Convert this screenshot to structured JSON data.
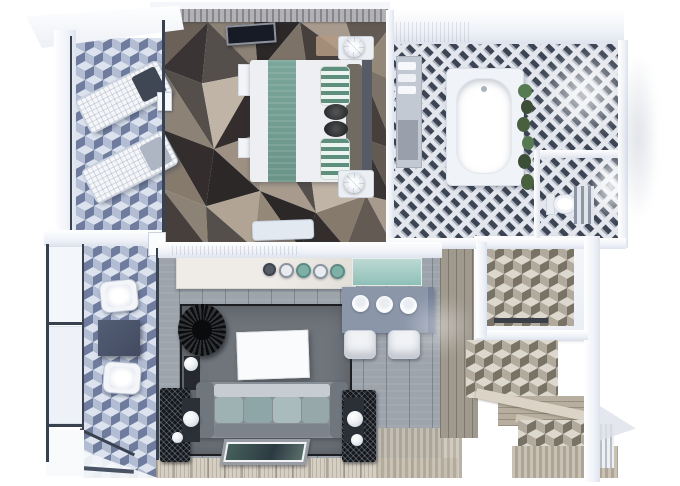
{
  "scene": {
    "type": "3d-floorplan-top-view-render",
    "rooms": [
      {
        "id": "balcony-upper",
        "label": "upper balcony",
        "items": [
          "lounge-chair",
          "lounge-chair",
          "side-table",
          "glass-railing",
          "canopy-roof",
          "cube-tile-floor"
        ]
      },
      {
        "id": "bedroom",
        "label": "bedroom",
        "items": [
          "wardrobe",
          "wall-tv",
          "faceted-area-rug",
          "double-bed",
          "teal-bed-runner",
          "striped-pillow",
          "striped-pillow",
          "bolster-cushion",
          "bolster-cushion",
          "headboard",
          "nightstand",
          "table-lamp",
          "nightstand",
          "table-lamp",
          "foot-bench",
          "luggage-bench"
        ]
      },
      {
        "id": "bathroom",
        "label": "bathroom",
        "items": [
          "bathtub",
          "hanging-plant",
          "vanity-shelf",
          "towels",
          "toilet",
          "towel-ladder",
          "shower-glass",
          "diagonal-tile-floor"
        ]
      },
      {
        "id": "kitchen-living",
        "label": "kitchen and living room",
        "items": [
          "kitchen-counter",
          "faucet-knobs",
          "glass-splashback",
          "dining-table",
          "bowl",
          "bowl",
          "bowl",
          "dining-chair",
          "dining-chair",
          "area-rug",
          "coffee-table",
          "rattan-chair",
          "sofa",
          "seat-cushions",
          "carved-screen",
          "carved-screen",
          "sphere-lamp",
          "sphere-lamp",
          "framed-picture",
          "wood-deck"
        ]
      },
      {
        "id": "balcony-lower",
        "label": "lower balcony",
        "items": [
          "barrel-chair",
          "square-table",
          "barrel-chair",
          "glass-railing",
          "cube-tile-floor"
        ]
      },
      {
        "id": "entry",
        "label": "entry hall",
        "items": [
          "hallway-wood-floor",
          "closet-room",
          "storage-bench",
          "cube-tile-foyer",
          "wood-steps",
          "striped-decking",
          "louver-panel"
        ]
      }
    ],
    "palette": {
      "background": "#ffffff",
      "wall_white": "#f5f7fa",
      "frame_dark": "#39414f",
      "cube_top": "#dce3ef",
      "cube_left": "#b2bcd3",
      "cube_right": "#6f7c9e",
      "cube_warm_top": "#ddd8ce",
      "cube_warm_left": "#b2ab9d",
      "cube_warm_right": "#797365",
      "bath_tile_base": "#e3e6ec",
      "bath_tile_dash": "#3d4554",
      "facet_rug_dark": "#2c2827",
      "facet_rug_light": "#c0b4a6",
      "bed_white": "#edeff3",
      "bed_runner_teal": "#76a195",
      "pillow_green": "#5f8f7f",
      "headboard": "#565b66",
      "wood_floor": "#9da4ab",
      "area_rug": "#70757c",
      "sofa": "#878e96",
      "sofa_cushion": "#9fb2b3",
      "coffee_table": "#fafbfc",
      "dining_table": "#8b96a9",
      "rattan_black": "#0b0c0e",
      "counter_marble": "#edeae6",
      "splash_teal": "#a3cbc5",
      "deck_wood": "#d5cfc3",
      "hall_wood": "#a09a8e",
      "step_wood": "#b7ae9f",
      "balcony_table": "#49536a",
      "screen_black": "#14171b",
      "plant_green": "#4c6442",
      "tv_screen": "#171b26",
      "lamp_white": "#f6f8fb"
    }
  }
}
